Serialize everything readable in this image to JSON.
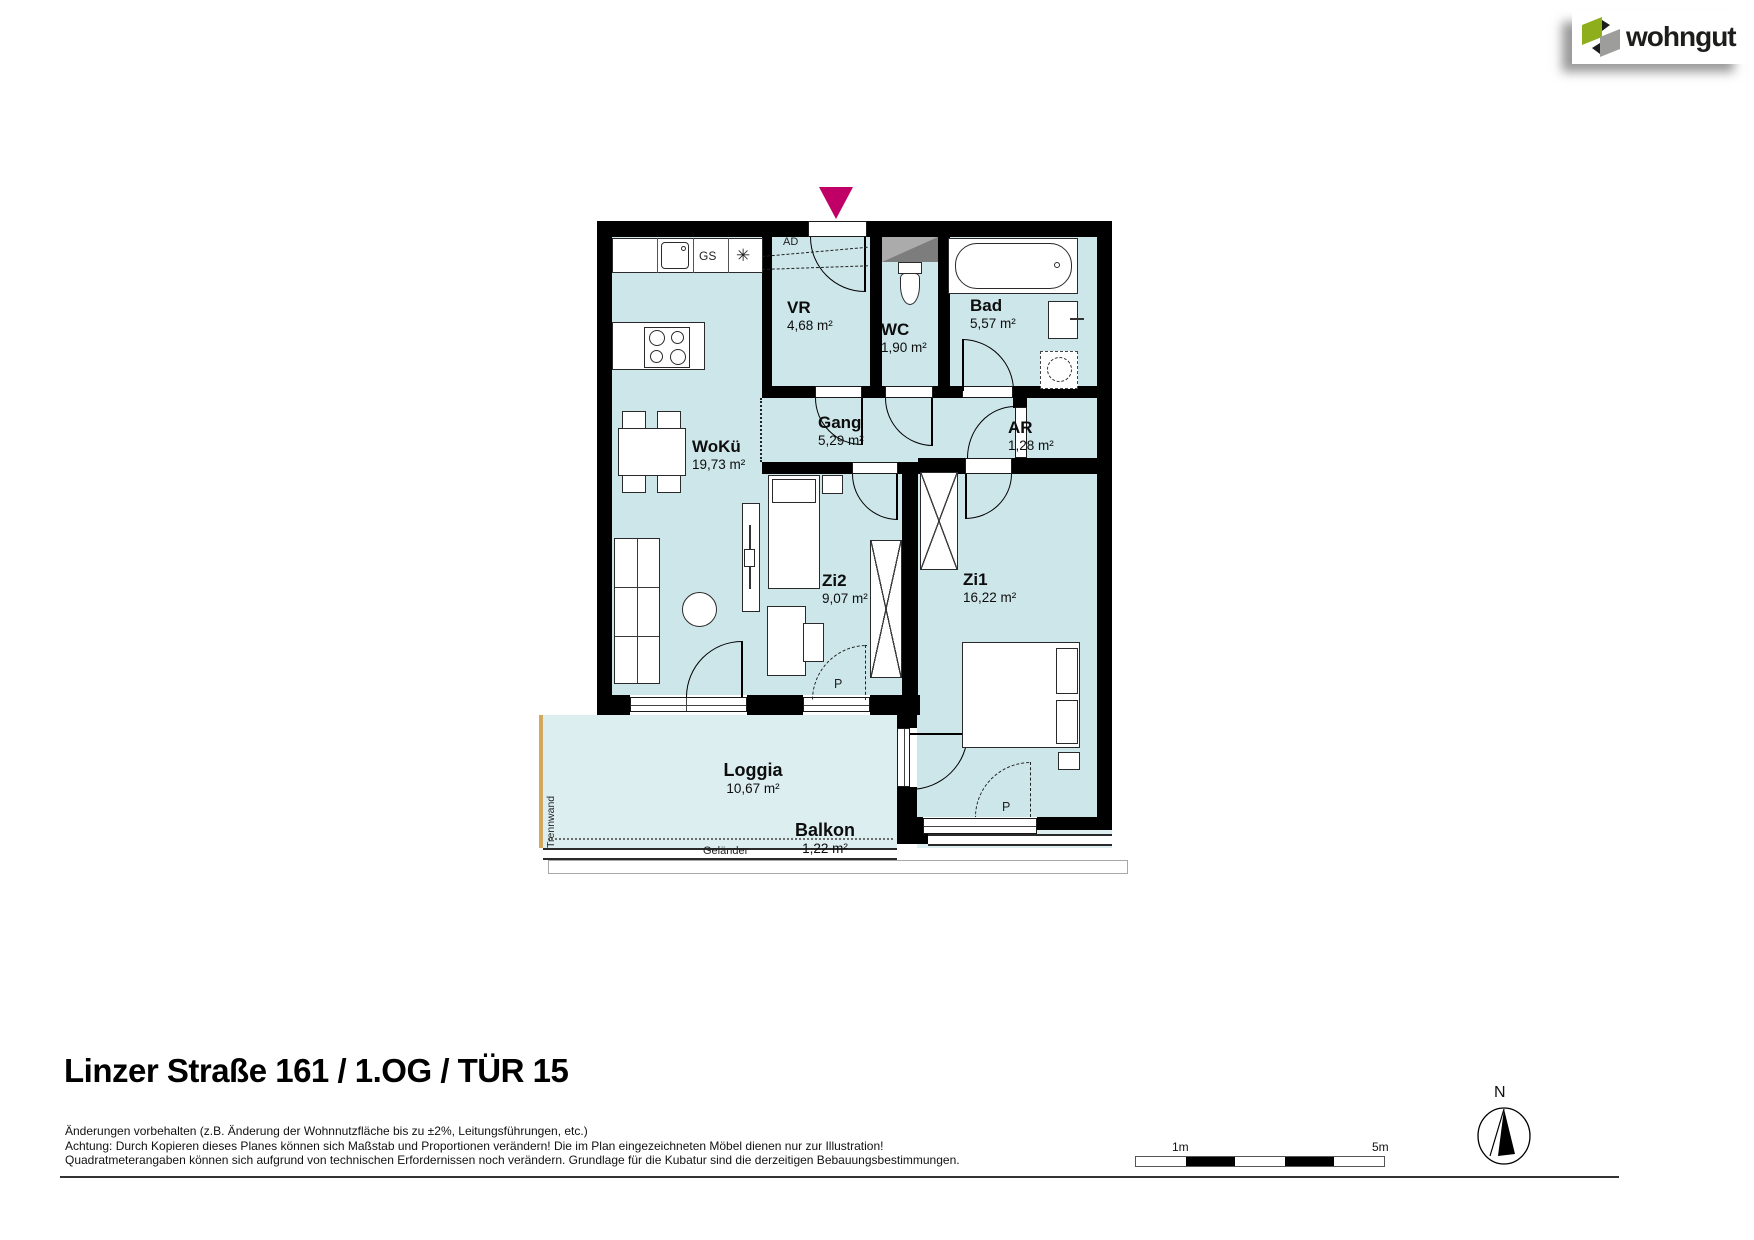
{
  "logo": {
    "brand": "wohngut"
  },
  "title": "Linzer Straße 161 / 1.OG / TÜR 15",
  "disclaimer": {
    "line1": "Änderungen vorbehalten (z.B. Änderung der Wohnnutzfläche bis zu ±2%, Leitungsführungen, etc.)",
    "line2": "Achtung: Durch Kopieren dieses Planes können sich Maßstab und Proportionen verändern! Die im Plan eingezeichneten Möbel dienen nur zur Illustration!",
    "line3": "Quadratmeterangaben können sich aufgrund von technischen Erfordernissen noch verändern. Grundlage für die Kubatur sind die derzeitigen Bebauungsbestimmungen."
  },
  "rooms": {
    "woku": {
      "name": "WoKü",
      "area": "19,73 m²"
    },
    "vr": {
      "name": "VR",
      "area": "4,68 m²"
    },
    "wc": {
      "name": "WC",
      "area": "1,90 m²"
    },
    "bad": {
      "name": "Bad",
      "area": "5,57 m²"
    },
    "gang": {
      "name": "Gang",
      "area": "5,29 m²"
    },
    "ar": {
      "name": "AR",
      "area": "1,28 m²"
    },
    "zi2": {
      "name": "Zi2",
      "area": "9,07 m²"
    },
    "zi1": {
      "name": "Zi1",
      "area": "16,22 m²"
    },
    "loggia": {
      "name": "Loggia",
      "area": "10,67 m²"
    },
    "balkon": {
      "name": "Balkon",
      "area": "1,22 m²"
    }
  },
  "annotations": {
    "ad": "AD",
    "gs": "GS",
    "freezer_symbol": "✳",
    "p": "P",
    "trennwand": "Trennwand",
    "gelaender": "Geländer"
  },
  "scalebar": {
    "one_m": "1m",
    "five_m": "5m"
  },
  "compass": {
    "north": "N"
  },
  "colors": {
    "room_fill": "#cde6ea",
    "loggia_fill": "#ddeef1",
    "wall": "#000000",
    "entrance_arrow": "#c10067",
    "logo_green": "#8fae1b",
    "logo_gray": "#9d9d9c",
    "shaft_light": "#ababab",
    "shaft_dark": "#7d7d7d",
    "trennwand": "#d2a85f"
  }
}
